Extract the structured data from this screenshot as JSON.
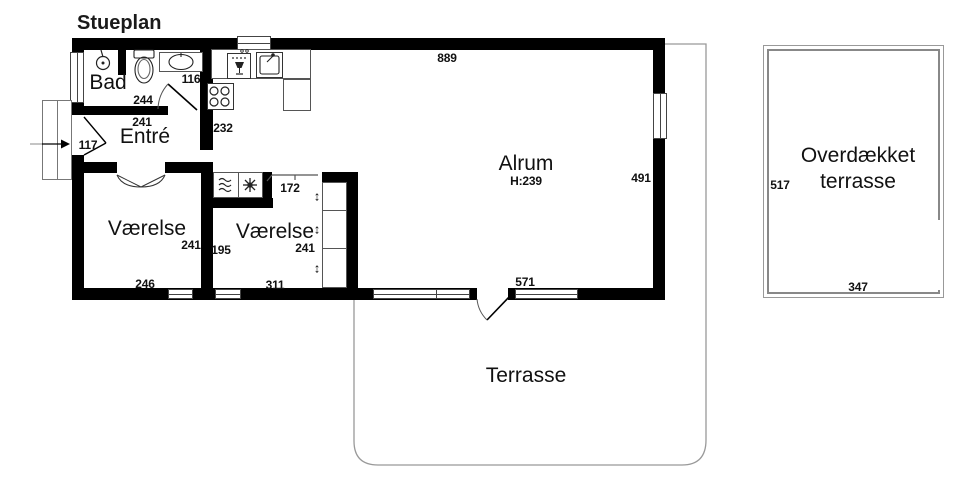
{
  "title": "Stueplan",
  "colors": {
    "wall": "#000000",
    "terrace_outline": "#999999",
    "text": "#1a1a1a"
  },
  "rooms": {
    "bad": {
      "label": "Bad"
    },
    "entre": {
      "label": "Entré"
    },
    "vaerelse1": {
      "label": "Værelse"
    },
    "vaerelse2": {
      "label": "Værelse"
    },
    "alrum": {
      "label": "Alrum",
      "ceiling_height": "H:239"
    },
    "terrasse": {
      "label": "Terrasse"
    },
    "overdaekket_terrasse": {
      "label": "Overdækket terrasse"
    }
  },
  "dimensions": {
    "alrum_top_width": "889",
    "bad_fixture_width": "116",
    "bad_width": "244",
    "entre_width": "241",
    "kitchen_wall": "232",
    "entry_door_width": "117",
    "vaerelse2_door_width": "172",
    "alrum_right_height": "491",
    "vaerelse1_height": "241",
    "vaerelse2_left_height": "195",
    "vaerelse2_height": "241",
    "vaerelse1_width": "246",
    "vaerelse2_width": "311",
    "alrum_terrace_door": "571",
    "overdaekket_height": "517",
    "overdaekket_width": "347"
  },
  "icons": {
    "wardrobe_slider": "↕"
  }
}
